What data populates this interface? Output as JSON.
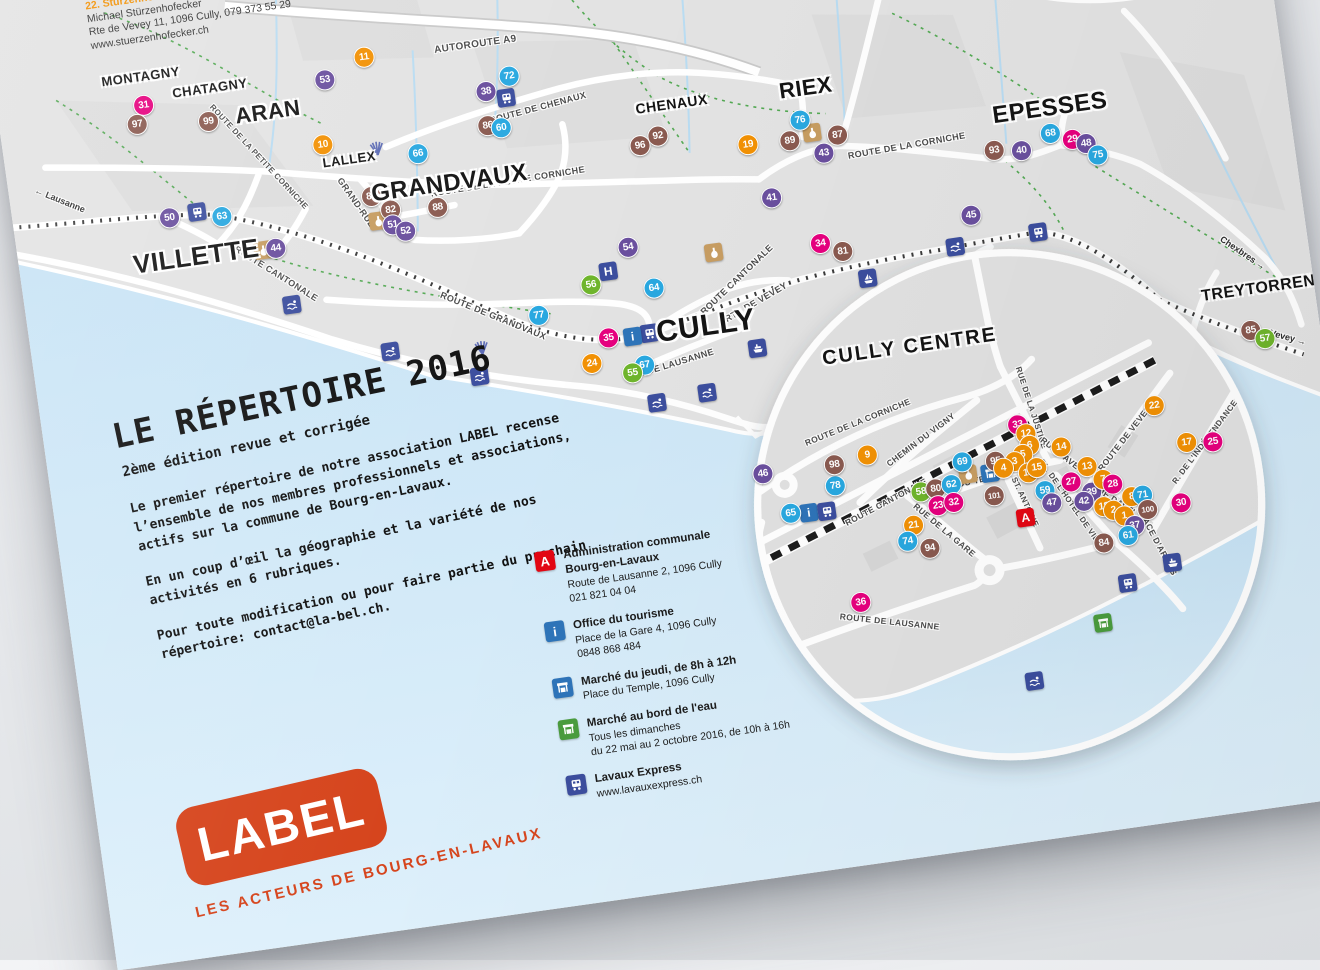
{
  "palette": {
    "categories": {
      "orange": "#F29104",
      "pink": "#E6007E",
      "purple": "#6A4F9E",
      "green": "#6FB52C",
      "blue": "#29A8E0",
      "brown": "#8A5A50"
    },
    "accent_red": "#D6451D",
    "admin_red": "#E30613",
    "icon_indigo": "#3C4E9E",
    "icon_blue": "#2E74B9",
    "market_green": "#4A9C3E",
    "wine_tan": "#C79D62",
    "lake": "#CDE7F7",
    "land": "#E3E3E3"
  },
  "directory_note": {
    "partial_top_line": "www.de",
    "entry_number": "22.",
    "entry_name": "Stürzenhofecker Michael",
    "lines": [
      "Michael Stürzenhofecker",
      "Rte de Vevey 11, 1096 Cully, 079 373 55 29",
      "www.stuerzenhofecker.ch"
    ]
  },
  "intro": {
    "title": "LE RÉPERTOIRE 2016",
    "subtitle": "2ème édition revue et corrigée",
    "paragraphs": [
      "Le premier répertoire de notre association LABEL recense l’ensemble de nos membres professionnels et associations, actifs sur la commune de Bourg-en-Lavaux.",
      "En un coup d’œil la géographie et la variété de nos activités en 6 rubriques.",
      "Pour toute modification ou pour faire partie du prochain répertoire: contact@la-bel.ch."
    ]
  },
  "legend": {
    "items": [
      {
        "icon": "admin",
        "title": "Administration communale\nBourg-en-Lavaux",
        "lines": [
          "Route de Lausanne 2, 1096 Cully",
          "021 821 04 04"
        ]
      },
      {
        "icon": "info",
        "title": "Office du tourisme",
        "lines": [
          "Place de la Gare 4, 1096 Cully",
          "0848 868 484"
        ]
      },
      {
        "icon": "market-blue",
        "title": "Marché du jeudi, de 8h à 12h",
        "lines": [
          "Place du Temple, 1096 Cully"
        ]
      },
      {
        "icon": "market-green",
        "title": "Marché au bord de l'eau",
        "lines": [
          "Tous les dimanches",
          "du 22 mai au 2 octobre 2016, de 10h à 16h"
        ]
      },
      {
        "icon": "train",
        "title": "Lavaux Express",
        "lines": [
          "www.lavauxexpress.ch"
        ]
      }
    ]
  },
  "logo": {
    "text": "LABEL",
    "tagline": "LES ACTEURS DE BOURG-EN-LAVAUX"
  },
  "map": {
    "towns": [
      {
        "name": "MONTAGNY",
        "x": 147,
        "y": 108,
        "s": 13
      },
      {
        "name": "CHATAGNY",
        "x": 214,
        "y": 129,
        "s": 13
      },
      {
        "name": "ARAN",
        "x": 268,
        "y": 161,
        "s": 22
      },
      {
        "name": "LALLEX",
        "x": 342,
        "y": 219,
        "s": 13
      },
      {
        "name": "GRANDVAUX",
        "x": 438,
        "y": 257,
        "s": 24
      },
      {
        "name": "CHENAUX",
        "x": 669,
        "y": 209,
        "s": 14
      },
      {
        "name": "RIEX",
        "x": 804,
        "y": 212,
        "s": 22
      },
      {
        "name": "EPESSES",
        "x": 1043,
        "y": 266,
        "s": 24
      },
      {
        "name": "VILLETTE",
        "x": 177,
        "y": 294,
        "s": 26
      },
      {
        "name": "CULLY",
        "x": 672,
        "y": 434,
        "s": 30
      },
      {
        "name": "TREYTORRENS",
        "x": 1230,
        "y": 474,
        "s": 16
      }
    ],
    "street_labels": [
      {
        "text": "AUTOROUTE A9",
        "x": 483,
        "y": 123,
        "rot": 0,
        "s": 10
      },
      {
        "text": "ROUTE DE CHENAUX",
        "x": 536,
        "y": 194,
        "rot": -7,
        "s": 9
      },
      {
        "text": "ROUTE DE LA PETITE CORNICHE",
        "x": 253,
        "y": 204,
        "rot": 55,
        "s": 8
      },
      {
        "text": "ROUTE DE LA PETITE CORNICHE",
        "x": 496,
        "y": 263,
        "rot": -1,
        "s": 9
      },
      {
        "text": "GRAND-RUE",
        "x": 343,
        "y": 263,
        "rot": 63,
        "s": 9
      },
      {
        "text": "ROUTE DE LA CORNICHE",
        "x": 896,
        "y": 283,
        "rot": -2,
        "s": 9
      },
      {
        "text": "ROUTE CANTONALE",
        "x": 254,
        "y": 322,
        "rot": 40,
        "s": 9
      },
      {
        "text": "ROUTE CANTONALE",
        "x": 709,
        "y": 392,
        "rot": -36,
        "s": 9
      },
      {
        "text": "RTE DE VEVEY",
        "x": 725,
        "y": 417,
        "rot": -22,
        "s": 9
      },
      {
        "text": "RTE DE LAUSANNE",
        "x": 631,
        "y": 467,
        "rot": -9,
        "s": 9
      },
      {
        "text": "ROUTE DE GRANDVAUX",
        "x": 463,
        "y": 394,
        "rot": 30,
        "s": 9
      }
    ],
    "direction_labels": [
      {
        "text": "← Lausanne",
        "x": 50,
        "y": 219,
        "rot": 30
      },
      {
        "text": "Chexbres →",
        "x": 1214,
        "y": 436,
        "rot": 42
      },
      {
        "text": "Vevey →",
        "x": 1247,
        "y": 526,
        "rot": 23
      }
    ],
    "markers": [
      {
        "n": "31",
        "c": "pink",
        "x": 146,
        "y": 137
      },
      {
        "n": "97",
        "c": "brown",
        "x": 137,
        "y": 155
      },
      {
        "n": "99",
        "c": "brown",
        "x": 208,
        "y": 162
      },
      {
        "n": "53",
        "c": "purple",
        "x": 329,
        "y": 137
      },
      {
        "n": "11",
        "c": "orange",
        "x": 371,
        "y": 120
      },
      {
        "n": "38",
        "c": "purple",
        "x": 487,
        "y": 171
      },
      {
        "n": "72",
        "c": "blue",
        "x": 512,
        "y": 159
      },
      {
        "n": "86",
        "c": "brown",
        "x": 484,
        "y": 205
      },
      {
        "n": "60",
        "c": "blue",
        "x": 497,
        "y": 209
      },
      {
        "n": "66",
        "c": "blue",
        "x": 411,
        "y": 223
      },
      {
        "n": "10",
        "c": "orange",
        "x": 318,
        "y": 201
      },
      {
        "n": "92",
        "c": "brown",
        "x": 651,
        "y": 239
      },
      {
        "n": "96",
        "c": "brown",
        "x": 632,
        "y": 246
      },
      {
        "n": "19",
        "c": "orange",
        "x": 739,
        "y": 260
      },
      {
        "n": "76",
        "c": "blue",
        "x": 794,
        "y": 243
      },
      {
        "n": "89",
        "c": "brown",
        "x": 781,
        "y": 262
      },
      {
        "n": "87",
        "c": "brown",
        "x": 829,
        "y": 263
      },
      {
        "n": "43",
        "c": "purple",
        "x": 813,
        "y": 279
      },
      {
        "n": "41",
        "c": "purple",
        "x": 755,
        "y": 316
      },
      {
        "n": "93",
        "c": "brown",
        "x": 982,
        "y": 300
      },
      {
        "n": "40",
        "c": "purple",
        "x": 1009,
        "y": 304
      },
      {
        "n": "68",
        "c": "blue",
        "x": 1040,
        "y": 291
      },
      {
        "n": "29",
        "c": "pink",
        "x": 1061,
        "y": 300
      },
      {
        "n": "48",
        "c": "purple",
        "x": 1074,
        "y": 306
      },
      {
        "n": "75",
        "c": "blue",
        "x": 1084,
        "y": 319
      },
      {
        "n": "45",
        "c": "purple",
        "x": 950,
        "y": 361
      },
      {
        "n": "34",
        "c": "pink",
        "x": 797,
        "y": 368
      },
      {
        "n": "81",
        "c": "brown",
        "x": 818,
        "y": 379
      },
      {
        "n": "83",
        "c": "brown",
        "x": 359,
        "y": 259
      },
      {
        "n": "82",
        "c": "brown",
        "x": 376,
        "y": 275
      },
      {
        "n": "88",
        "c": "brown",
        "x": 423,
        "y": 279
      },
      {
        "n": "51",
        "c": "purple",
        "x": 376,
        "y": 290
      },
      {
        "n": "52",
        "c": "purple",
        "x": 388,
        "y": 298
      },
      {
        "n": "50",
        "c": "purple",
        "x": 156,
        "y": 252
      },
      {
        "n": "63",
        "c": "blue",
        "x": 208,
        "y": 258
      },
      {
        "n": "44",
        "c": "purple",
        "x": 257,
        "y": 297
      },
      {
        "n": "54",
        "c": "purple",
        "x": 606,
        "y": 345
      },
      {
        "n": "56",
        "c": "green",
        "x": 564,
        "y": 377
      },
      {
        "n": "64",
        "c": "blue",
        "x": 626,
        "y": 389
      },
      {
        "n": "77",
        "c": "blue",
        "x": 508,
        "y": 400
      },
      {
        "n": "35",
        "c": "pink",
        "x": 574,
        "y": 432
      },
      {
        "n": "24",
        "c": "orange",
        "x": 554,
        "y": 455
      },
      {
        "n": "67",
        "c": "blue",
        "x": 606,
        "y": 464
      },
      {
        "n": "55",
        "c": "green",
        "x": 593,
        "y": 470
      },
      {
        "n": "85",
        "c": "brown",
        "x": 1211,
        "y": 514
      },
      {
        "n": "57",
        "c": "green",
        "x": 1224,
        "y": 524
      }
    ],
    "icons": [
      {
        "t": "train",
        "x": 184,
        "y": 250
      },
      {
        "t": "train",
        "x": 506,
        "y": 180
      },
      {
        "t": "train",
        "x": 615,
        "y": 433
      },
      {
        "t": "train",
        "x": 1014,
        "y": 387
      },
      {
        "t": "info",
        "x": 598,
        "y": 434
      },
      {
        "t": "hotel",
        "x": 583,
        "y": 366
      },
      {
        "t": "wine",
        "x": 804,
        "y": 257
      },
      {
        "t": "wine",
        "x": 362,
        "y": 284
      },
      {
        "t": "wine",
        "x": 690,
        "y": 362
      },
      {
        "t": "wine",
        "x": 244,
        "y": 297
      },
      {
        "t": "boat",
        "x": 720,
        "y": 463
      },
      {
        "t": "sail",
        "x": 839,
        "y": 409
      },
      {
        "t": "swim",
        "x": 265,
        "y": 355
      },
      {
        "t": "swim",
        "x": 356,
        "y": 415
      },
      {
        "t": "swim",
        "x": 441,
        "y": 452
      },
      {
        "t": "swim",
        "x": 613,
        "y": 503
      },
      {
        "t": "swim",
        "x": 664,
        "y": 500
      },
      {
        "t": "swim",
        "x": 930,
        "y": 390
      },
      {
        "t": "fan",
        "x": 371,
        "y": 212
      },
      {
        "t": "fan",
        "x": 447,
        "y": 424
      }
    ],
    "inset": {
      "title": "CULLY CENTRE",
      "cx": 948,
      "cy": 653,
      "r": 252,
      "street_labels": [
        {
          "text": "ROUTE DE LA CORNICHE",
          "x": 809,
          "y": 550,
          "rot": -14,
          "s": 8.5
        },
        {
          "text": "CHEMIN DU VIGNY",
          "x": 869,
          "y": 576,
          "rot": -29,
          "s": 8.5
        },
        {
          "text": "ROUTE CANTONALE",
          "x": 826,
          "y": 633,
          "rot": -20,
          "s": 8.5
        },
        {
          "text": "RUE DE LA JUSTICE",
          "x": 983,
          "y": 560,
          "rot": 80,
          "s": 8
        },
        {
          "text": "ROUTE DE VEVEY",
          "x": 1071,
          "y": 603,
          "rot": -44,
          "s": 8.5
        },
        {
          "text": "R. DE L'INDÉPENDANCE",
          "x": 1150,
          "y": 618,
          "rot": -45,
          "s": 8
        },
        {
          "text": "RUE DAVEL",
          "x": 1007,
          "y": 611,
          "rot": 46,
          "s": 8.5
        },
        {
          "text": "RUE DAVEL",
          "x": 1053,
          "y": 663,
          "rot": 41,
          "s": 8.5
        },
        {
          "text": "R. DU TEMPLE",
          "x": 920,
          "y": 624,
          "rot": -5,
          "s": 8.5
        },
        {
          "text": "R. ST. ANTOINE",
          "x": 962,
          "y": 647,
          "rot": 73,
          "s": 8
        },
        {
          "text": "PL. DE L'HOTEL DE VILLE",
          "x": 1010,
          "y": 662,
          "rot": 63,
          "s": 8
        },
        {
          "text": "RUE DE LA GARE",
          "x": 880,
          "y": 669,
          "rot": 48,
          "s": 8.5
        },
        {
          "text": "ROUTE DE LAUSANNE",
          "x": 813,
          "y": 752,
          "rot": 14,
          "s": 8.5
        },
        {
          "text": "PLACE D'ARMES",
          "x": 1089,
          "y": 710,
          "rot": 70,
          "s": 8.5
        }
      ],
      "markers": [
        {
          "n": "46",
          "c": "purple",
          "x": 708,
          "y": 588
        },
        {
          "n": "78",
          "c": "blue",
          "x": 778,
          "y": 610
        },
        {
          "n": "65",
          "c": "blue",
          "x": 730,
          "y": 631
        },
        {
          "n": "98",
          "c": "brown",
          "x": 780,
          "y": 589
        },
        {
          "n": "9",
          "c": "orange",
          "x": 814,
          "y": 584
        },
        {
          "n": "36",
          "c": "pink",
          "x": 787,
          "y": 729
        },
        {
          "n": "21",
          "c": "orange",
          "x": 850,
          "y": 660
        },
        {
          "n": "74",
          "c": "blue",
          "x": 842,
          "y": 675
        },
        {
          "n": "94",
          "c": "brown",
          "x": 863,
          "y": 685
        },
        {
          "n": "58",
          "c": "green",
          "x": 862,
          "y": 628
        },
        {
          "n": "80",
          "c": "brown",
          "x": 877,
          "y": 627
        },
        {
          "n": "62",
          "c": "blue",
          "x": 893,
          "y": 625
        },
        {
          "n": "23",
          "c": "pink",
          "x": 877,
          "y": 644
        },
        {
          "n": "32",
          "c": "pink",
          "x": 893,
          "y": 643
        },
        {
          "n": "69",
          "c": "blue",
          "x": 907,
          "y": 604
        },
        {
          "n": "95",
          "c": "brown",
          "x": 940,
          "y": 608
        },
        {
          "n": "101",
          "c": "brown",
          "x": 934,
          "y": 642
        },
        {
          "n": "33",
          "c": "pink",
          "x": 967,
          "y": 575
        },
        {
          "n": "12",
          "c": "orange",
          "x": 974,
          "y": 585
        },
        {
          "n": "6",
          "c": "orange",
          "x": 976,
          "y": 597
        },
        {
          "n": "5",
          "c": "orange",
          "x": 968,
          "y": 605
        },
        {
          "n": "3",
          "c": "orange",
          "x": 959,
          "y": 611
        },
        {
          "n": "4",
          "c": "orange",
          "x": 947,
          "y": 616
        },
        {
          "n": "16",
          "c": "orange",
          "x": 971,
          "y": 624
        },
        {
          "n": "15",
          "c": "orange",
          "x": 980,
          "y": 620
        },
        {
          "n": "14",
          "c": "orange",
          "x": 1007,
          "y": 603
        },
        {
          "n": "13",
          "c": "orange",
          "x": 1030,
          "y": 626
        },
        {
          "n": "59",
          "c": "blue",
          "x": 985,
          "y": 644
        },
        {
          "n": "47",
          "c": "purple",
          "x": 990,
          "y": 657
        },
        {
          "n": "27",
          "c": "pink",
          "x": 1012,
          "y": 639
        },
        {
          "n": "39",
          "c": "purple",
          "x": 1031,
          "y": 652
        },
        {
          "n": "42",
          "c": "purple",
          "x": 1022,
          "y": 660
        },
        {
          "n": "22",
          "c": "orange",
          "x": 1105,
          "y": 575
        },
        {
          "n": "17",
          "c": "orange",
          "x": 1132,
          "y": 616
        },
        {
          "n": "25",
          "c": "pink",
          "x": 1158,
          "y": 619
        },
        {
          "n": "7",
          "c": "orange",
          "x": 1044,
          "y": 641
        },
        {
          "n": "28",
          "c": "pink",
          "x": 1053,
          "y": 647
        },
        {
          "n": "8",
          "c": "orange",
          "x": 1070,
          "y": 662
        },
        {
          "n": "71",
          "c": "blue",
          "x": 1081,
          "y": 662
        },
        {
          "n": "18",
          "c": "orange",
          "x": 1041,
          "y": 668
        },
        {
          "n": "2",
          "c": "orange",
          "x": 1050,
          "y": 673
        },
        {
          "n": "1",
          "c": "orange",
          "x": 1060,
          "y": 680
        },
        {
          "n": "100",
          "c": "brown",
          "x": 1084,
          "y": 677
        },
        {
          "n": "37",
          "c": "purple",
          "x": 1069,
          "y": 691
        },
        {
          "n": "61",
          "c": "blue",
          "x": 1061,
          "y": 700
        },
        {
          "n": "84",
          "c": "brown",
          "x": 1036,
          "y": 704
        },
        {
          "n": "30",
          "c": "pink",
          "x": 1118,
          "y": 675
        }
      ],
      "icons": [
        {
          "t": "info",
          "x": 748,
          "y": 633
        },
        {
          "t": "train",
          "x": 766,
          "y": 634
        },
        {
          "t": "wine",
          "x": 911,
          "y": 617
        },
        {
          "t": "market-blue",
          "x": 933,
          "y": 619
        },
        {
          "t": "admin",
          "x": 962,
          "y": 668
        },
        {
          "t": "train",
          "x": 1054,
          "y": 747
        },
        {
          "t": "market-green",
          "x": 1024,
          "y": 783
        },
        {
          "t": "swim",
          "x": 948,
          "y": 831
        },
        {
          "t": "boat",
          "x": 1101,
          "y": 733
        }
      ]
    }
  }
}
